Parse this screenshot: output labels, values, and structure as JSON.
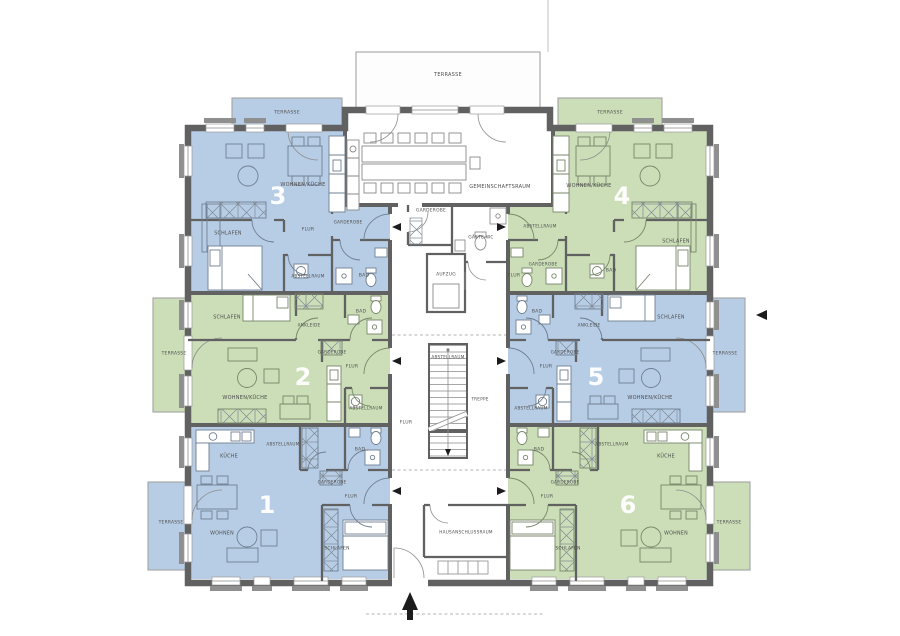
{
  "plan": {
    "type": "architectural-floor-plan",
    "language": "de",
    "colors": {
      "unit_blue": "#b7cde5",
      "unit_green": "#cbdeb7",
      "wall_gray": "#616161",
      "label_text": "#4e4e4e",
      "number_text": "#ffffff",
      "background": "#ffffff"
    },
    "apartments": [
      {
        "number": "1",
        "color": "blue",
        "x": 267,
        "y": 505
      },
      {
        "number": "2",
        "color": "green",
        "x": 303,
        "y": 377
      },
      {
        "number": "3",
        "color": "blue",
        "x": 278,
        "y": 196
      },
      {
        "number": "4",
        "color": "green",
        "x": 622,
        "y": 196
      },
      {
        "number": "5",
        "color": "blue",
        "x": 596,
        "y": 377
      },
      {
        "number": "6",
        "color": "green",
        "x": 628,
        "y": 505
      }
    ],
    "room_labels": [
      {
        "text": "TERRASSE",
        "x": 448,
        "y": 75,
        "fs": 5
      },
      {
        "text": "TERRASSE",
        "x": 287,
        "y": 113,
        "fs": 4.6
      },
      {
        "text": "TERRASSE",
        "x": 610,
        "y": 113,
        "fs": 4.6
      },
      {
        "text": "TERRASSE",
        "x": 174,
        "y": 354,
        "fs": 4.4
      },
      {
        "text": "TERRASSE",
        "x": 725,
        "y": 354,
        "fs": 4.4
      },
      {
        "text": "TERRASSE",
        "x": 171,
        "y": 523,
        "fs": 4.4
      },
      {
        "text": "TERRASSE",
        "x": 729,
        "y": 523,
        "fs": 4.4
      },
      {
        "text": "GEMEINSCHAFTSRAUM",
        "x": 500,
        "y": 187,
        "fs": 5
      },
      {
        "text": "GARDEROBE",
        "x": 431,
        "y": 211,
        "fs": 4.4
      },
      {
        "text": "GÄSTE-WC",
        "x": 481,
        "y": 238,
        "fs": 4.4
      },
      {
        "text": "AUFZUG",
        "x": 446,
        "y": 275,
        "fs": 4.4
      },
      {
        "text": "ABSTELLRAUM",
        "x": 448,
        "y": 357,
        "fs": 4.2
      },
      {
        "text": "TREPPE",
        "x": 480,
        "y": 399,
        "fs": 4.2
      },
      {
        "text": "FLUR",
        "x": 406,
        "y": 423,
        "fs": 4.6
      },
      {
        "text": "HAUSANSCHLUSSRAUM",
        "x": 466,
        "y": 532,
        "fs": 4.2
      },
      {
        "text": "WOHNEN/KÜCHE",
        "x": 303,
        "y": 185,
        "fs": 5
      },
      {
        "text": "SCHLAFEN",
        "x": 228,
        "y": 234,
        "fs": 4.8
      },
      {
        "text": "FLUR",
        "x": 308,
        "y": 230,
        "fs": 4.6
      },
      {
        "text": "GARDEROBE",
        "x": 348,
        "y": 222,
        "fs": 4.2
      },
      {
        "text": "ABSTELLRAUM",
        "x": 308,
        "y": 276,
        "fs": 4.2
      },
      {
        "text": "BAD",
        "x": 364,
        "y": 276,
        "fs": 4.6
      },
      {
        "text": "WOHNEN/KÜCHE",
        "x": 589,
        "y": 186,
        "fs": 5
      },
      {
        "text": "SCHLAFEN",
        "x": 676,
        "y": 242,
        "fs": 4.8
      },
      {
        "text": "FLUR",
        "x": 514,
        "y": 276,
        "fs": 4.6
      },
      {
        "text": "GARDEROBE",
        "x": 543,
        "y": 264,
        "fs": 4.2
      },
      {
        "text": "ABSTELLRAUM",
        "x": 540,
        "y": 226,
        "fs": 4.2
      },
      {
        "text": "BAD",
        "x": 611,
        "y": 271,
        "fs": 4.6
      },
      {
        "text": "SCHLAFEN",
        "x": 227,
        "y": 318,
        "fs": 4.8
      },
      {
        "text": "ANKLEIDE",
        "x": 309,
        "y": 325,
        "fs": 4.2
      },
      {
        "text": "BAD",
        "x": 361,
        "y": 312,
        "fs": 4.6
      },
      {
        "text": "GARDEROBE",
        "x": 332,
        "y": 352,
        "fs": 4.2
      },
      {
        "text": "FLUR",
        "x": 352,
        "y": 367,
        "fs": 4.6
      },
      {
        "text": "WOHNEN/KÜCHE",
        "x": 245,
        "y": 398,
        "fs": 5
      },
      {
        "text": "ABSTELLRAUM",
        "x": 366,
        "y": 408,
        "fs": 4.2
      },
      {
        "text": "BAD",
        "x": 537,
        "y": 312,
        "fs": 4.6
      },
      {
        "text": "ANKLEIDE",
        "x": 589,
        "y": 325,
        "fs": 4.2
      },
      {
        "text": "SCHLAFEN",
        "x": 671,
        "y": 318,
        "fs": 4.8
      },
      {
        "text": "GARDEROBE",
        "x": 565,
        "y": 352,
        "fs": 4.2
      },
      {
        "text": "FLUR",
        "x": 546,
        "y": 367,
        "fs": 4.6
      },
      {
        "text": "ABSTELLRAUM",
        "x": 531,
        "y": 408,
        "fs": 4.2
      },
      {
        "text": "WOHNEN/KÜCHE",
        "x": 650,
        "y": 398,
        "fs": 5
      },
      {
        "text": "KÜCHE",
        "x": 229,
        "y": 457,
        "fs": 4.8
      },
      {
        "text": "ABSTELLRAUM",
        "x": 283,
        "y": 444,
        "fs": 4.2
      },
      {
        "text": "BAD",
        "x": 360,
        "y": 450,
        "fs": 4.6
      },
      {
        "text": "GARDEROBE",
        "x": 332,
        "y": 482,
        "fs": 4.2
      },
      {
        "text": "FLUR",
        "x": 351,
        "y": 497,
        "fs": 4.6
      },
      {
        "text": "WOHNEN",
        "x": 222,
        "y": 534,
        "fs": 4.8
      },
      {
        "text": "SCHLAFEN",
        "x": 337,
        "y": 549,
        "fs": 4.4
      },
      {
        "text": "BAD",
        "x": 539,
        "y": 450,
        "fs": 4.6
      },
      {
        "text": "ABSTELLRAUM",
        "x": 612,
        "y": 444,
        "fs": 4.2
      },
      {
        "text": "KÜCHE",
        "x": 666,
        "y": 457,
        "fs": 4.8
      },
      {
        "text": "GARDEROBE",
        "x": 565,
        "y": 482,
        "fs": 4.2
      },
      {
        "text": "FLUR",
        "x": 547,
        "y": 497,
        "fs": 4.6
      },
      {
        "text": "SCHLAFEN",
        "x": 568,
        "y": 549,
        "fs": 4.4
      },
      {
        "text": "WOHNEN",
        "x": 676,
        "y": 534,
        "fs": 4.8
      }
    ]
  }
}
